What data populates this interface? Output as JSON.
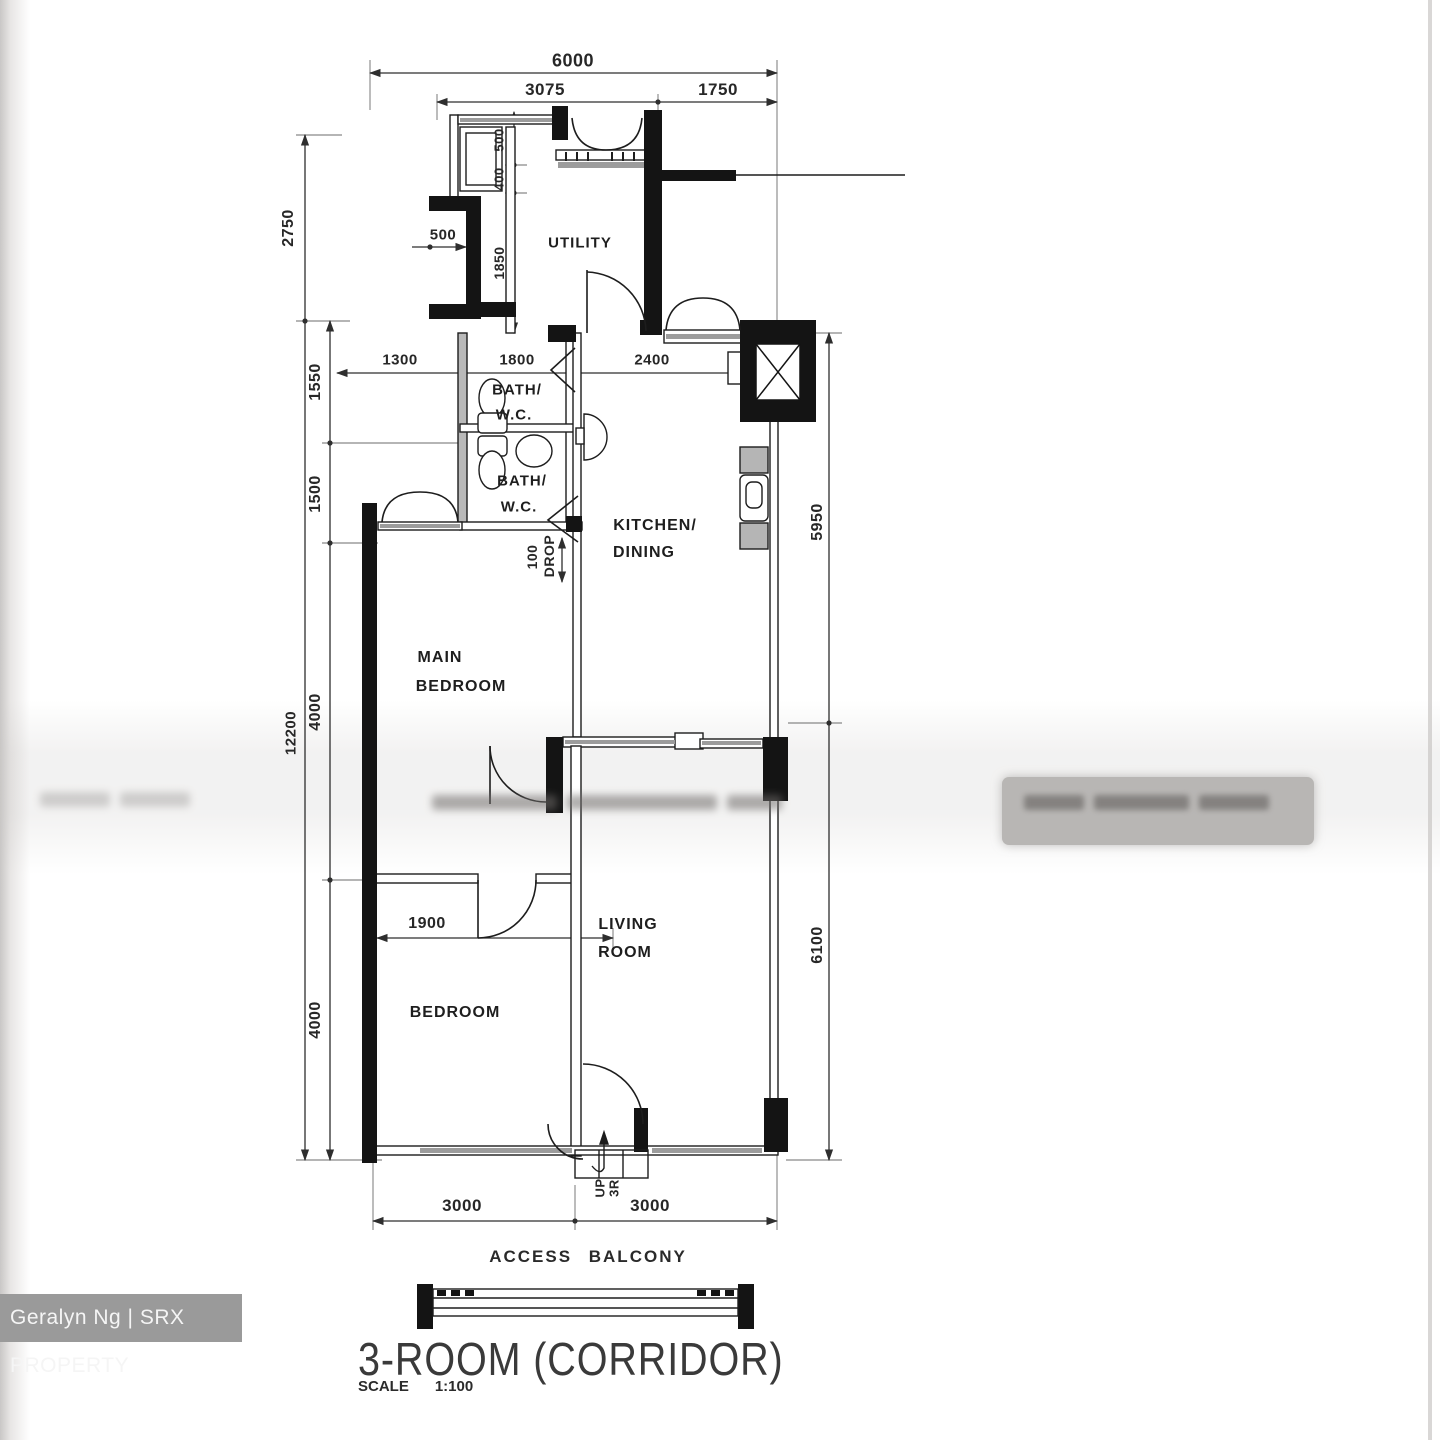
{
  "plan": {
    "rooms": {
      "utility": "UTILITY",
      "bath1_l1": "BATH/",
      "bath1_l2": "W.C.",
      "bath2_l1": "BATH/",
      "bath2_l2": "W.C.",
      "kitchen_l1": "KITCHEN/",
      "kitchen_l2": "DINING",
      "main_bedroom_l1": "MAIN",
      "main_bedroom_l2": "BEDROOM",
      "bedroom": "BEDROOM",
      "living_l1": "LIVING",
      "living_l2": "ROOM"
    },
    "dims": {
      "top_overall": "6000",
      "top_left": "3075",
      "top_right": "1750",
      "left_upper": "2750",
      "left_total": "12200",
      "seg_1550": "1550",
      "seg_1500": "1500",
      "seg_4000a": "4000",
      "seg_4000b": "4000",
      "right_upper": "5950",
      "right_lower": "6100",
      "inner_1300": "1300",
      "inner_1800": "1800",
      "inner_2400": "2400",
      "recess_500": "500",
      "niche_500": "500",
      "niche_400": "400",
      "niche_1850": "1850",
      "drop_100": "100",
      "drop_label": "DROP",
      "bedroom_1900": "1900",
      "bottom_left_3000": "3000",
      "bottom_right_3000": "3000"
    },
    "annotations": {
      "up": "UP",
      "steps": "3R",
      "access_balcony": "ACCESS BALCONY"
    }
  },
  "title_block": {
    "title": "3-ROOM (CORRIDOR)",
    "scale_label": "SCALE",
    "scale_value": "1:100"
  },
  "watermark": {
    "agent": "Geralyn Ng | SRX PROPERTY"
  },
  "colors": {
    "line": "#2e2e2e",
    "wall": "#141414",
    "window_band": "#9c9c9c",
    "watermark_bg": "#9a9a9a",
    "watermark_text": "#f5f5f5",
    "blur_box": "#b8b6b4"
  }
}
